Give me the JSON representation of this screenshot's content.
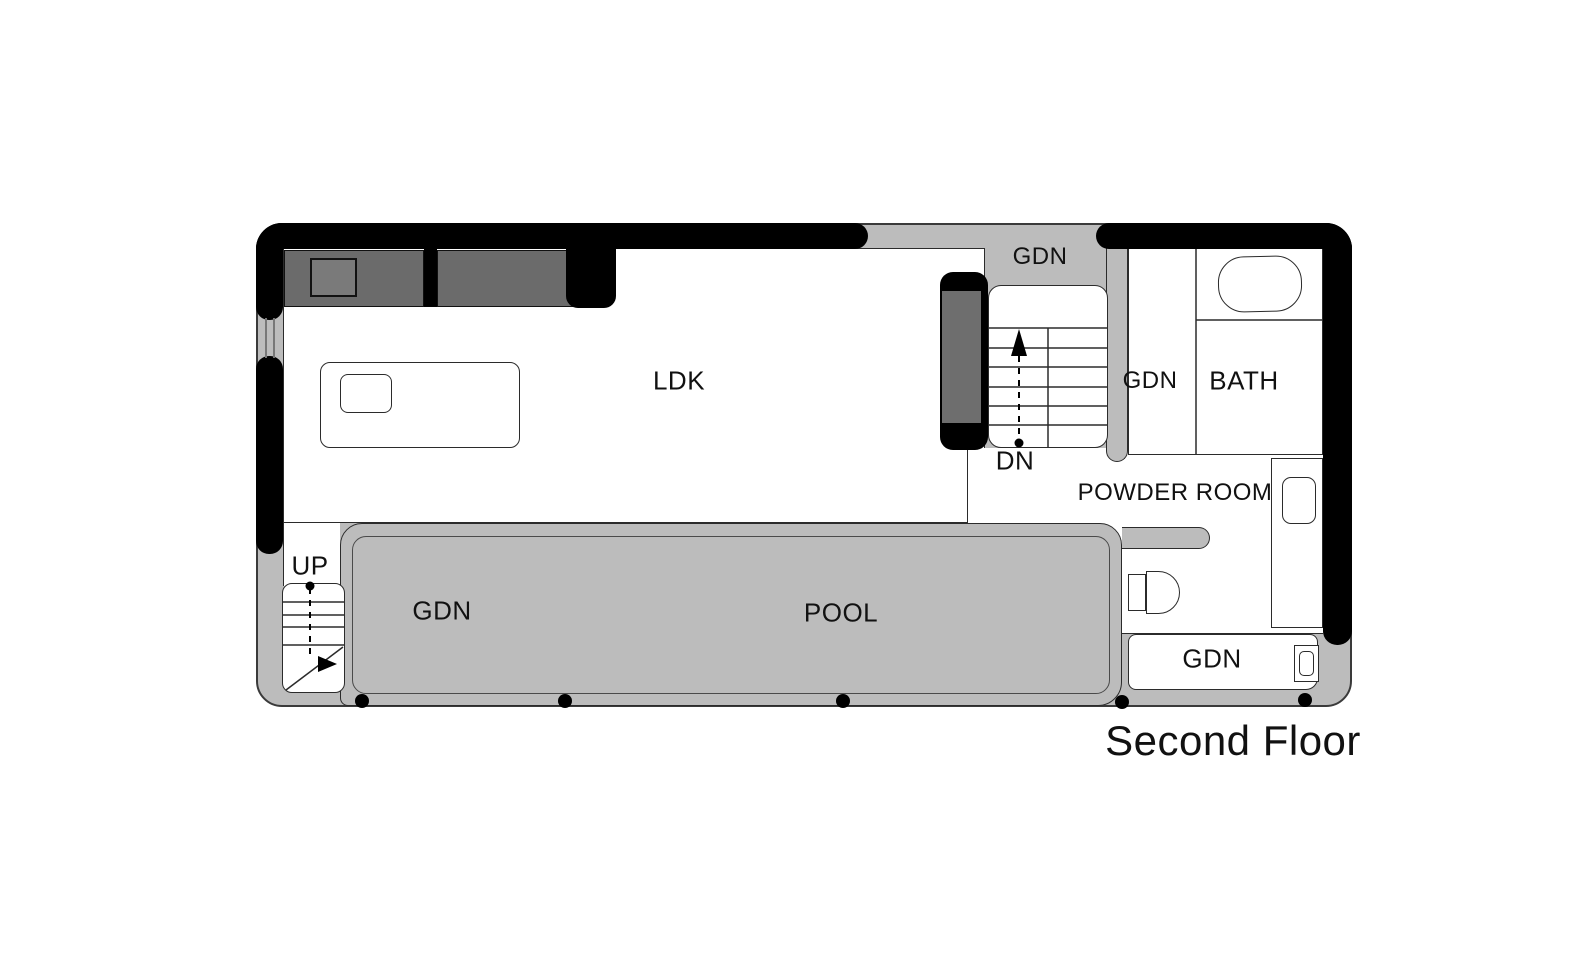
{
  "title": "Second Floor",
  "rooms": {
    "ldk": "LDK",
    "bath": "BATH",
    "powder_room": "POWDER ROOM",
    "pool": "POOL",
    "gdn_top": "GDN",
    "gdn_mid": "GDN",
    "gdn_deck": "GDN",
    "gdn_bottom": "GDN"
  },
  "stairs": {
    "up_label": "UP",
    "down_label": "DN"
  },
  "colors": {
    "wall": "#000000",
    "deck_gray": "#bcbcbc",
    "counter_gray": "#6b6b6b",
    "partition_gray": "#6e6e6e",
    "outline": "#2b2b2b",
    "background": "#ffffff"
  }
}
